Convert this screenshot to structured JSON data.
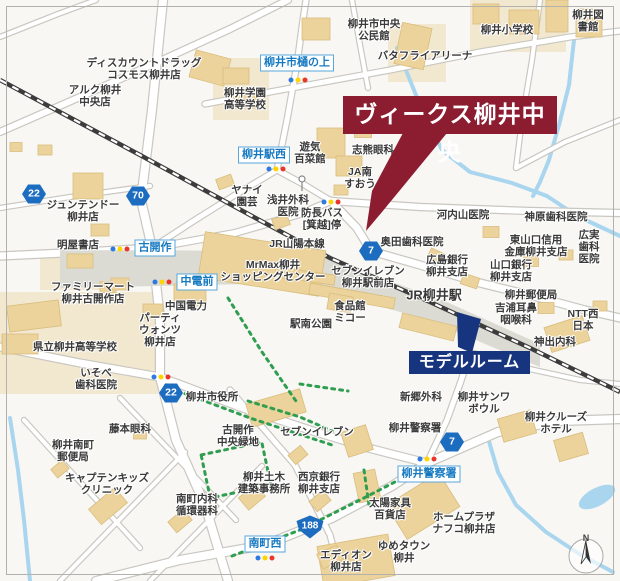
{
  "title_banner": {
    "text": "ヴィークス柳井中央"
  },
  "model_room_banner": {
    "text": "モデルルーム"
  },
  "compass": {
    "north_label": "N"
  },
  "colors": {
    "banner_red": "#8c1c30",
    "model_navy": "#17357e",
    "bus_blue": "#1579c2",
    "shield_blue": "#1c6cc0",
    "building_fill": "#ecd39b",
    "building_stroke": "#d9bd7d",
    "ground_beige": "#f2e8cf",
    "river_blue": "#a9d6ee",
    "green": "#2f9e50",
    "rail_dark": "#3c3c3c",
    "station_gray": "#dbdbd3",
    "road_casing": "#c9c7c0",
    "bg": "#f8f7f4",
    "signal_blue": "#2f7ae0",
    "signal_yellow": "#ffd400",
    "signal_red": "#e8362d"
  },
  "place_labels": [
    {
      "t": "柳井市中央\n公民館",
      "x": 374,
      "y": 30
    },
    {
      "t": "バタフライアリーナ",
      "x": 425,
      "y": 56
    },
    {
      "t": "柳井小学校",
      "x": 507,
      "y": 30
    },
    {
      "t": "柳井図書館",
      "x": 588,
      "y": 21
    },
    {
      "t": "ディスカウントドラッグ\nコスモス柳井店",
      "x": 144,
      "y": 69
    },
    {
      "t": "柳井学園\n高等学校",
      "x": 245,
      "y": 99
    },
    {
      "t": "アルク柳井\n中央店",
      "x": 95,
      "y": 96
    },
    {
      "t": "ジュンテンドー\n柳井店",
      "x": 83,
      "y": 211
    },
    {
      "t": "明屋書店",
      "x": 78,
      "y": 245
    },
    {
      "t": "ファミリーマート\n柳井古開作店",
      "x": 93,
      "y": 293
    },
    {
      "t": "中国電力",
      "x": 186,
      "y": 306
    },
    {
      "t": "パーティ\nウォンツ\n柳井店",
      "x": 160,
      "y": 330
    },
    {
      "t": "県立柳井高等学校",
      "x": 75,
      "y": 347
    },
    {
      "t": "いそべ\n歯科医院",
      "x": 96,
      "y": 379
    },
    {
      "t": "柳井市役所",
      "x": 212,
      "y": 397
    },
    {
      "t": "藤本眼科",
      "x": 130,
      "y": 429
    },
    {
      "t": "柳井南町\n郵便局",
      "x": 73,
      "y": 451
    },
    {
      "t": "キャプテンキッズ\nクリニック",
      "x": 107,
      "y": 484
    },
    {
      "t": "南町内科\n循環器科",
      "x": 197,
      "y": 505
    },
    {
      "t": "古開作\n中央緑地",
      "x": 238,
      "y": 436
    },
    {
      "t": "セブンイレブン",
      "x": 317,
      "y": 432
    },
    {
      "t": "柳井土木\n建築事務所",
      "x": 264,
      "y": 483
    },
    {
      "t": "西京銀行\n柳井支店",
      "x": 319,
      "y": 483
    },
    {
      "t": "エディオン\n柳井店",
      "x": 346,
      "y": 561
    },
    {
      "t": "ゆめタウン\n柳井",
      "x": 404,
      "y": 552
    },
    {
      "t": "太陽家具\n百貨店",
      "x": 390,
      "y": 509
    },
    {
      "t": "ホームプラザ\nナフコ柳井店",
      "x": 464,
      "y": 523
    },
    {
      "t": "柳井警察署",
      "x": 415,
      "y": 428
    },
    {
      "t": "新郷外科",
      "x": 421,
      "y": 397
    },
    {
      "t": "柳井サンワ\nボウル",
      "x": 484,
      "y": 403
    },
    {
      "t": "柳井クルーズ\nホテル",
      "x": 556,
      "y": 423
    },
    {
      "t": "神出内科",
      "x": 555,
      "y": 342
    },
    {
      "t": "NTT西日本",
      "x": 583,
      "y": 320
    },
    {
      "t": "吉浦耳鼻\n咽喉科",
      "x": 516,
      "y": 314
    },
    {
      "t": "柳井郵便局",
      "x": 531,
      "y": 295
    },
    {
      "t": "山口銀行\n柳井支店",
      "x": 511,
      "y": 271
    },
    {
      "t": "東山口信用\n金庫柳井支店",
      "x": 536,
      "y": 246
    },
    {
      "t": "広実歯科\n医院",
      "x": 589,
      "y": 247
    },
    {
      "t": "神原歯科医院",
      "x": 556,
      "y": 217
    },
    {
      "t": "河内山医院",
      "x": 463,
      "y": 215
    },
    {
      "t": "広島銀行\n柳井支店",
      "x": 447,
      "y": 266
    },
    {
      "t": "奥田歯科医院",
      "x": 412,
      "y": 242
    },
    {
      "t": "セブンイレブン\n柳井駅前店",
      "x": 368,
      "y": 277
    },
    {
      "t": "食品館\nミコー",
      "x": 350,
      "y": 312
    },
    {
      "t": "駅南公園",
      "x": 311,
      "y": 324
    },
    {
      "t": "MrMax柳井\nショッピングセンター",
      "x": 273,
      "y": 271
    },
    {
      "t": "JR山陽本線",
      "x": 297,
      "y": 244
    },
    {
      "t": "防長バス\n[箕越]停",
      "x": 322,
      "y": 219
    },
    {
      "t": "浅井外科\n医院",
      "x": 288,
      "y": 206
    },
    {
      "t": "ヤナイ\n園芸",
      "x": 247,
      "y": 196
    },
    {
      "t": "遊気\n百菜館",
      "x": 310,
      "y": 153
    },
    {
      "t": "志熊眼科",
      "x": 373,
      "y": 150
    },
    {
      "t": "JA南\nすおう",
      "x": 360,
      "y": 178
    },
    {
      "t": "JR柳井駅",
      "x": 434,
      "y": 296,
      "s": 13
    }
  ],
  "bus_stops": [
    {
      "label": "柳井市樋の上",
      "x": 297,
      "y": 63
    },
    {
      "label": "柳井駅西",
      "x": 264,
      "y": 155
    },
    {
      "label": "古開作",
      "x": 155,
      "y": 248
    },
    {
      "label": "中電前",
      "x": 197,
      "y": 282
    },
    {
      "label": "柳井警察署",
      "x": 429,
      "y": 474
    },
    {
      "label": "南町西",
      "x": 265,
      "y": 544
    }
  ],
  "route_shields": [
    {
      "number": "22",
      "kind": "hex",
      "x": 34,
      "y": 194
    },
    {
      "number": "70",
      "kind": "hex",
      "x": 138,
      "y": 196
    },
    {
      "number": "7",
      "kind": "hex",
      "x": 371,
      "y": 251
    },
    {
      "number": "22",
      "kind": "hex",
      "x": 171,
      "y": 393
    },
    {
      "number": "7",
      "kind": "hex",
      "x": 452,
      "y": 442
    },
    {
      "number": "188",
      "kind": "national",
      "x": 310,
      "y": 527
    }
  ],
  "traffic_lights": [
    {
      "x": 298,
      "y": 80
    },
    {
      "x": 276,
      "y": 169
    },
    {
      "x": 331,
      "y": 202
    },
    {
      "x": 120,
      "y": 249
    },
    {
      "x": 162,
      "y": 282
    },
    {
      "x": 161,
      "y": 377
    },
    {
      "x": 427,
      "y": 459
    },
    {
      "x": 265,
      "y": 558
    }
  ]
}
